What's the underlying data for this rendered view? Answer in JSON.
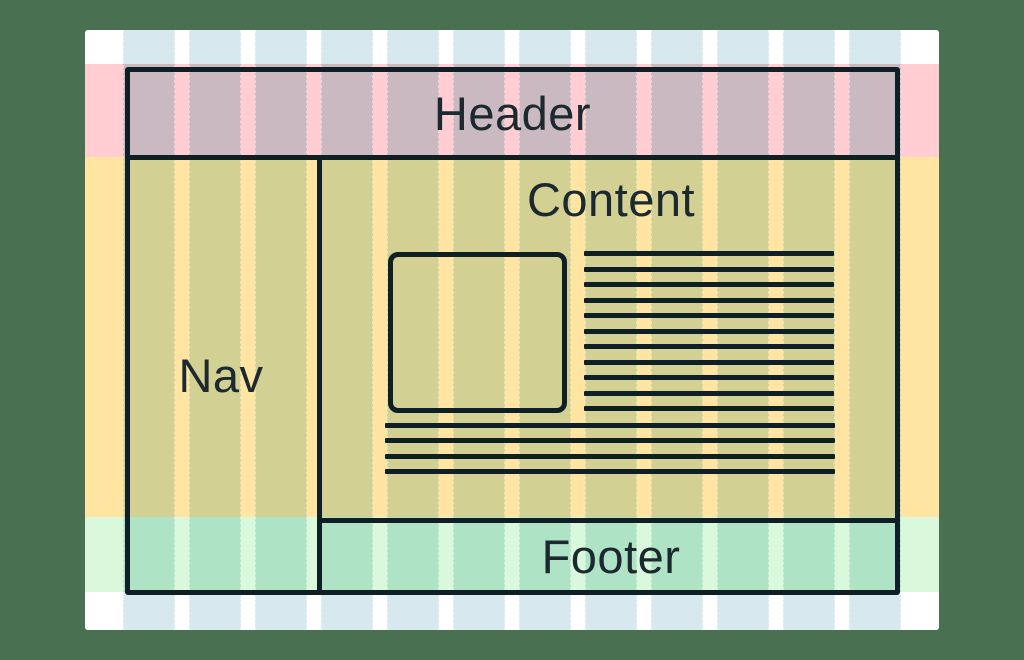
{
  "labels": {
    "header": "Header",
    "nav": "Nav",
    "content": "Content",
    "footer": "Footer"
  },
  "grid": {
    "columns": 12
  },
  "placeholder": {
    "lines_beside_image": 11,
    "lines_full_width": 4
  },
  "colors": {
    "background": "#4a7052",
    "page_bg": "#ffffff",
    "band_pink": "#ffcdd2",
    "band_yellow": "#ffe5a1",
    "band_green": "#daf8dc",
    "col_on_white": "#d7e8ee",
    "col_on_pink": "#cbb9c2",
    "col_on_yellow": "#d2d093",
    "col_on_green": "#afe3c5",
    "line": "#0e2025",
    "text": "#1c2a2f"
  }
}
